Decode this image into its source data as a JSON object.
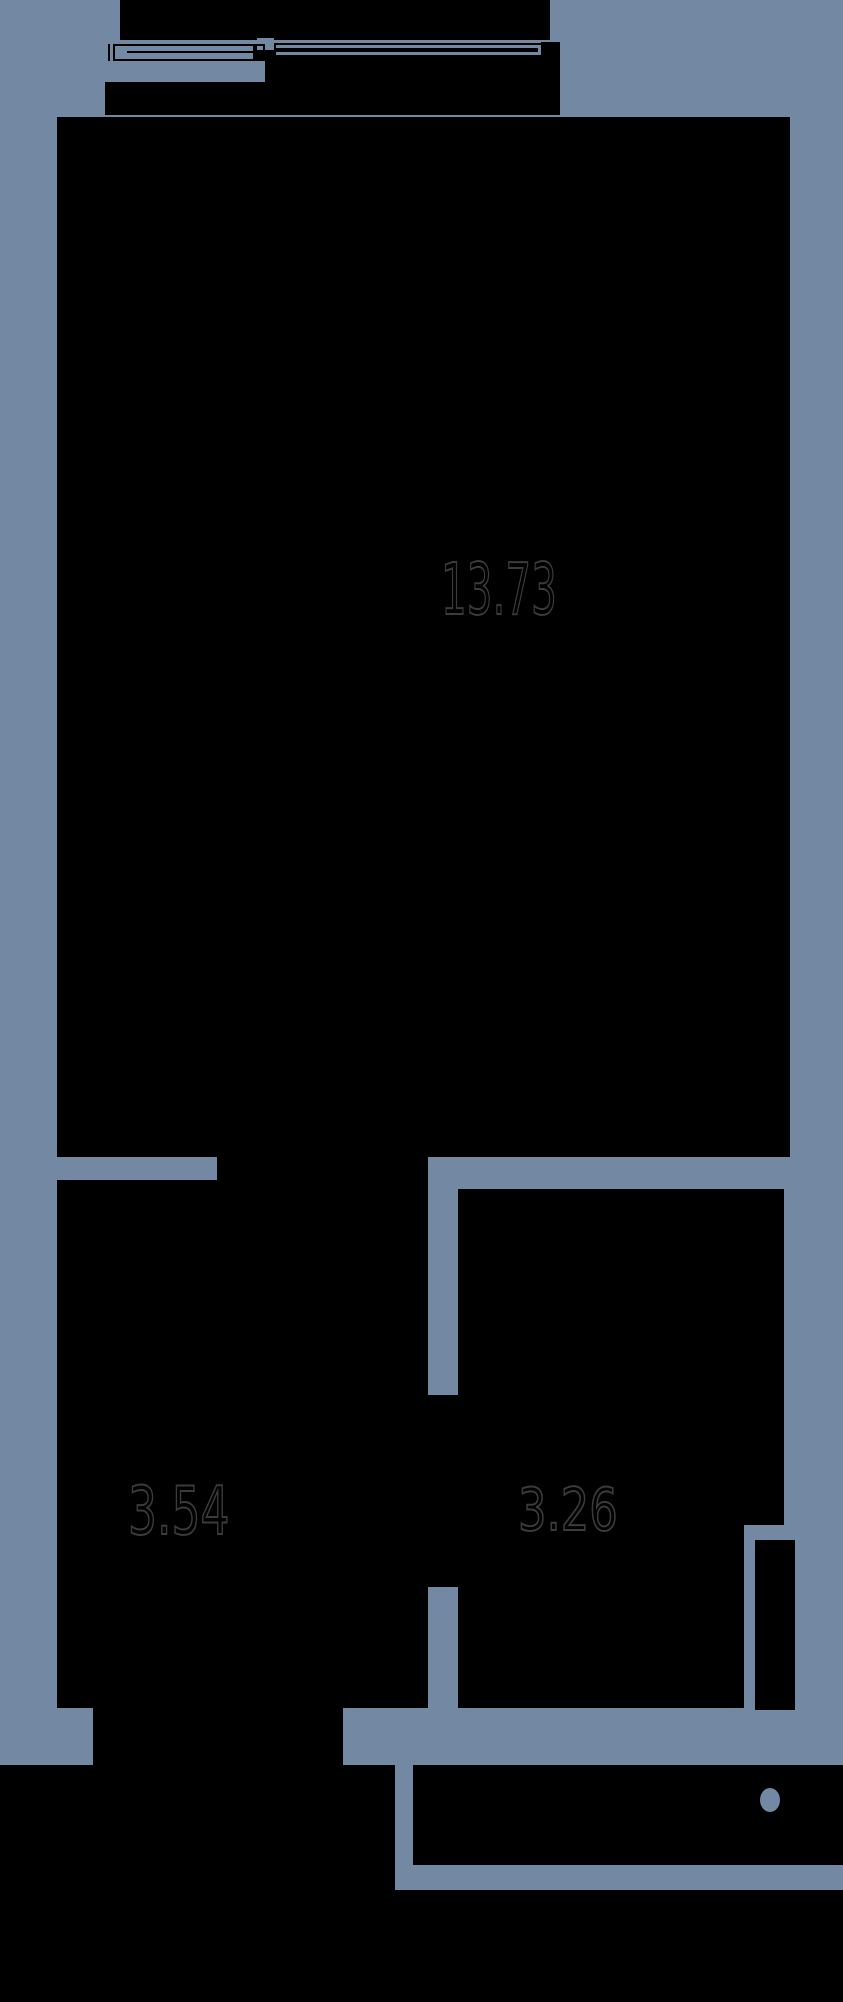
{
  "meta": {
    "type": "floor-plan",
    "canvas": {
      "width": 843,
      "height": 2002
    }
  },
  "colors": {
    "background": "#7388A3",
    "ink": "#000000",
    "label_stroke": "#3b3b3b"
  },
  "rooms": [
    {
      "id": "main-room",
      "area": "13.73"
    },
    {
      "id": "room-left",
      "area": "3.54"
    },
    {
      "id": "room-right",
      "area": "3.26"
    }
  ],
  "labels": [
    {
      "name": "area-label-main",
      "text": "13.73",
      "x": 441,
      "y": 554,
      "size": 71,
      "scale_x": 0.57
    },
    {
      "name": "area-label-left",
      "text": "3.54",
      "x": 128,
      "y": 1478,
      "size": 67,
      "scale_x": 0.68
    },
    {
      "name": "area-label-right",
      "text": "3.26",
      "x": 518,
      "y": 1480,
      "size": 59,
      "scale_x": 0.76
    }
  ],
  "shapes": [
    {
      "name": "balcony-parapet",
      "kind": "ink",
      "x": 120,
      "y": 0,
      "w": 430,
      "h": 40
    },
    {
      "name": "window-sash-junction",
      "kind": "ink",
      "x": 253,
      "y": 44,
      "w": 21,
      "h": 17
    },
    {
      "name": "window-right-sash",
      "kind": "ink",
      "x": 274,
      "y": 43,
      "w": 274,
      "h": 18
    },
    {
      "name": "window-right-jamb",
      "kind": "ink",
      "x": 541,
      "y": 42,
      "w": 19,
      "h": 40
    },
    {
      "name": "window-sill-block",
      "kind": "ink",
      "x": 265,
      "y": 55,
      "w": 283,
      "h": 27
    },
    {
      "name": "balcony-floor",
      "kind": "ink",
      "x": 105,
      "y": 82,
      "w": 455,
      "h": 33
    },
    {
      "name": "window-left-sash-midline",
      "kind": "ink",
      "x": 127,
      "y": 51,
      "w": 136,
      "h": 2
    },
    {
      "name": "window-left-jamb-line",
      "kind": "ink",
      "x": 108,
      "y": 44,
      "w": 2,
      "h": 17
    },
    {
      "name": "main-room-fill",
      "kind": "ink",
      "x": 57,
      "y": 117,
      "w": 733,
      "h": 1040
    },
    {
      "name": "opening-main-to-left",
      "kind": "ink",
      "x": 217,
      "y": 1157,
      "w": 211,
      "h": 25
    },
    {
      "name": "room-left-fill",
      "kind": "ink",
      "x": 57,
      "y": 1180,
      "w": 371,
      "h": 528
    },
    {
      "name": "room-right-fill",
      "kind": "ink",
      "x": 458,
      "y": 1189,
      "w": 326,
      "h": 336
    },
    {
      "name": "room-right-fill-lower",
      "kind": "ink",
      "x": 458,
      "y": 1525,
      "w": 286,
      "h": 183
    },
    {
      "name": "divider-door-opening",
      "kind": "ink",
      "x": 428,
      "y": 1398,
      "w": 30,
      "h": 188
    },
    {
      "name": "divider-jamb-top",
      "kind": "ink",
      "x": 426,
      "y": 1395,
      "w": 34,
      "h": 4
    },
    {
      "name": "divider-jamb-bottom",
      "kind": "ink",
      "x": 426,
      "y": 1583,
      "w": 34,
      "h": 4
    },
    {
      "name": "right-door-leaf",
      "kind": "ink",
      "x": 755,
      "y": 1540,
      "w": 40,
      "h": 170
    },
    {
      "name": "opening-left-to-hall",
      "kind": "ink",
      "x": 93,
      "y": 1708,
      "w": 250,
      "h": 57
    },
    {
      "name": "hall-fill",
      "kind": "ink",
      "x": 0,
      "y": 1765,
      "w": 395,
      "h": 237
    },
    {
      "name": "bath-fill",
      "kind": "ink",
      "x": 413,
      "y": 1765,
      "w": 430,
      "h": 100
    },
    {
      "name": "bottom-wall-strip",
      "kind": "ink",
      "x": 0,
      "y": 1890,
      "w": 843,
      "h": 112
    },
    {
      "name": "window-gap-notch",
      "kind": "bg",
      "x": 257,
      "y": 38,
      "w": 17,
      "h": 12
    },
    {
      "name": "window-glass-line-upper",
      "kind": "bg",
      "x": 276,
      "y": 45,
      "w": 264,
      "h": 2.5
    },
    {
      "name": "window-glass-line-lower",
      "kind": "bg",
      "x": 276,
      "y": 52,
      "w": 264,
      "h": 2.5
    },
    {
      "name": "window-glass-line-end",
      "kind": "bg",
      "x": 538,
      "y": 45,
      "w": 3,
      "h": 9.5
    },
    {
      "name": "fixture-circle",
      "kind": "bg-ellipse",
      "x": 760,
      "y": 1788,
      "w": 20,
      "h": 24
    },
    {
      "name": "window-left-sash-frame",
      "kind": "frame",
      "x": 113,
      "y": 44,
      "w": 152,
      "h": 17
    }
  ]
}
